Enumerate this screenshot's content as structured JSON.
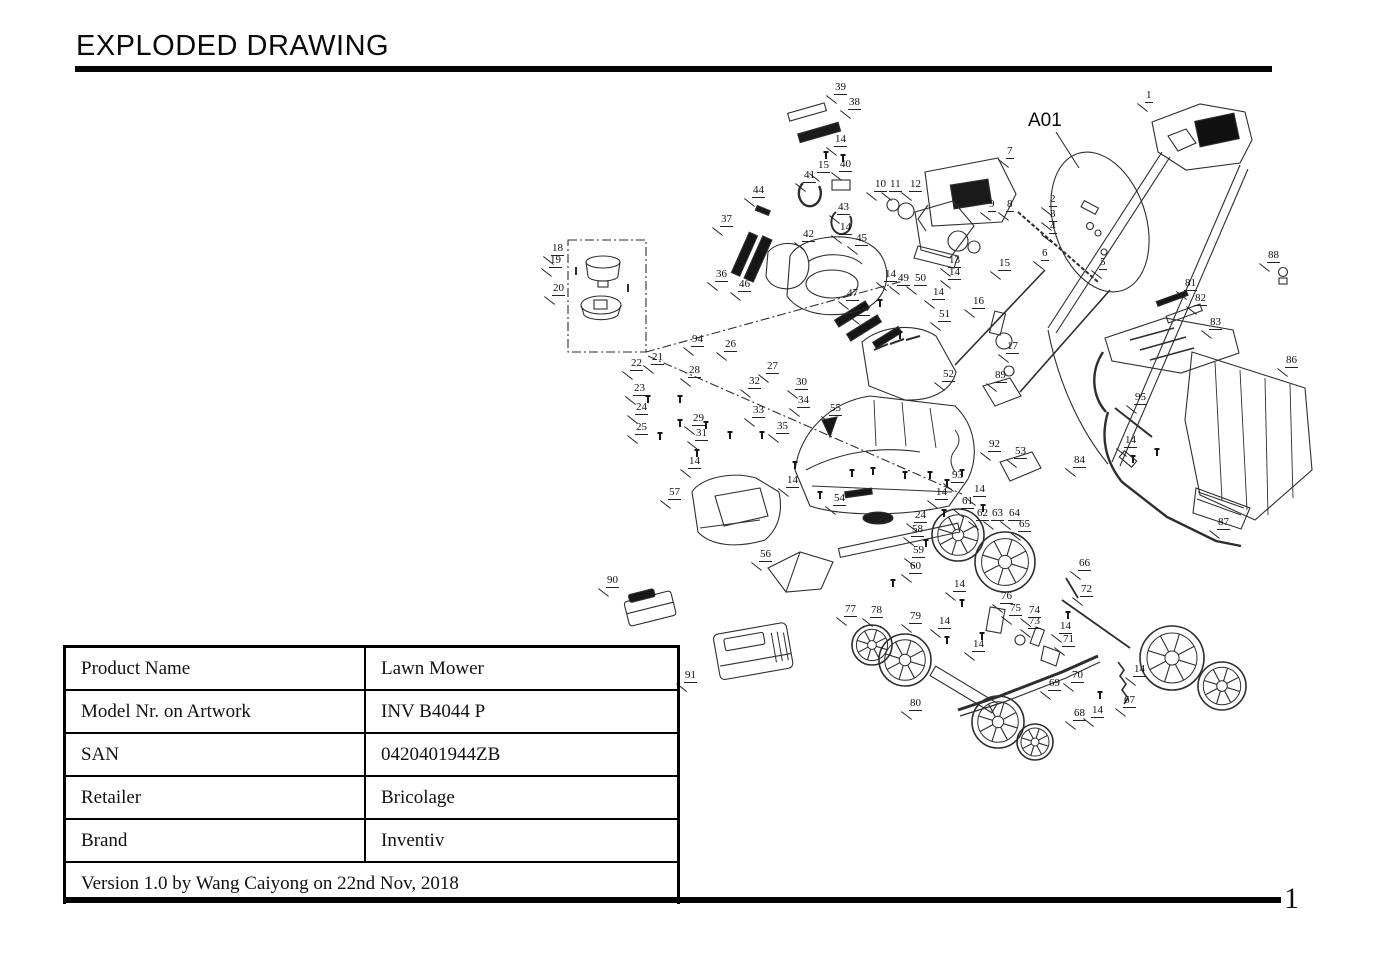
{
  "page": {
    "title": "EXPLODED DRAWING",
    "page_number": "1"
  },
  "diagram": {
    "assembly_callout": "A01",
    "labels": [
      {
        "n": "39",
        "x": 843,
        "y": 90
      },
      {
        "n": "38",
        "x": 857,
        "y": 105
      },
      {
        "n": "14",
        "x": 843,
        "y": 142
      },
      {
        "n": "15",
        "x": 826,
        "y": 168
      },
      {
        "n": "40",
        "x": 848,
        "y": 167
      },
      {
        "n": "41",
        "x": 812,
        "y": 178
      },
      {
        "n": "44",
        "x": 761,
        "y": 193
      },
      {
        "n": "43",
        "x": 846,
        "y": 210
      },
      {
        "n": "37",
        "x": 729,
        "y": 222
      },
      {
        "n": "42",
        "x": 811,
        "y": 237
      },
      {
        "n": "14",
        "x": 848,
        "y": 230
      },
      {
        "n": "45",
        "x": 864,
        "y": 241
      },
      {
        "n": "36",
        "x": 724,
        "y": 277
      },
      {
        "n": "46",
        "x": 747,
        "y": 287
      },
      {
        "n": "47",
        "x": 855,
        "y": 296
      },
      {
        "n": "48",
        "x": 866,
        "y": 311
      },
      {
        "n": "10",
        "x": 883,
        "y": 187
      },
      {
        "n": "11",
        "x": 898,
        "y": 187
      },
      {
        "n": "12",
        "x": 918,
        "y": 187
      },
      {
        "n": "7",
        "x": 1015,
        "y": 154
      },
      {
        "n": "9",
        "x": 997,
        "y": 207
      },
      {
        "n": "8",
        "x": 1015,
        "y": 207
      },
      {
        "n": "13",
        "x": 957,
        "y": 263
      },
      {
        "n": "14",
        "x": 957,
        "y": 275
      },
      {
        "n": "15",
        "x": 1007,
        "y": 266
      },
      {
        "n": "16",
        "x": 981,
        "y": 304
      },
      {
        "n": "17",
        "x": 1015,
        "y": 349
      },
      {
        "n": "14",
        "x": 893,
        "y": 277
      },
      {
        "n": "49",
        "x": 906,
        "y": 281
      },
      {
        "n": "50",
        "x": 923,
        "y": 281
      },
      {
        "n": "14",
        "x": 941,
        "y": 295
      },
      {
        "n": "51",
        "x": 947,
        "y": 317
      },
      {
        "n": "1",
        "x": 1154,
        "y": 98
      },
      {
        "n": "2",
        "x": 1058,
        "y": 202
      },
      {
        "n": "3",
        "x": 1058,
        "y": 217
      },
      {
        "n": "4",
        "x": 1058,
        "y": 229
      },
      {
        "n": "6",
        "x": 1050,
        "y": 256
      },
      {
        "n": "5",
        "x": 1108,
        "y": 265
      },
      {
        "n": "88",
        "x": 1276,
        "y": 258
      },
      {
        "n": "81",
        "x": 1193,
        "y": 286
      },
      {
        "n": "82",
        "x": 1203,
        "y": 301
      },
      {
        "n": "83",
        "x": 1218,
        "y": 325
      },
      {
        "n": "86",
        "x": 1294,
        "y": 363
      },
      {
        "n": "95",
        "x": 1143,
        "y": 400
      },
      {
        "n": "14",
        "x": 1133,
        "y": 443
      },
      {
        "n": "84",
        "x": 1082,
        "y": 463
      },
      {
        "n": "87",
        "x": 1226,
        "y": 525
      },
      {
        "n": "18",
        "x": 560,
        "y": 251
      },
      {
        "n": "19",
        "x": 558,
        "y": 263
      },
      {
        "n": "20",
        "x": 561,
        "y": 291
      },
      {
        "n": "94",
        "x": 700,
        "y": 342
      },
      {
        "n": "26",
        "x": 733,
        "y": 347
      },
      {
        "n": "21",
        "x": 660,
        "y": 360
      },
      {
        "n": "22",
        "x": 639,
        "y": 366
      },
      {
        "n": "28",
        "x": 697,
        "y": 373
      },
      {
        "n": "27",
        "x": 775,
        "y": 369
      },
      {
        "n": "32",
        "x": 757,
        "y": 384
      },
      {
        "n": "30",
        "x": 804,
        "y": 385
      },
      {
        "n": "23",
        "x": 642,
        "y": 391
      },
      {
        "n": "34",
        "x": 806,
        "y": 403
      },
      {
        "n": "24",
        "x": 644,
        "y": 410
      },
      {
        "n": "33",
        "x": 761,
        "y": 413
      },
      {
        "n": "29",
        "x": 701,
        "y": 421
      },
      {
        "n": "25",
        "x": 644,
        "y": 430
      },
      {
        "n": "31",
        "x": 704,
        "y": 436
      },
      {
        "n": "35",
        "x": 785,
        "y": 429
      },
      {
        "n": "55",
        "x": 838,
        "y": 411
      },
      {
        "n": "52",
        "x": 951,
        "y": 377
      },
      {
        "n": "89",
        "x": 1003,
        "y": 378
      },
      {
        "n": "92",
        "x": 997,
        "y": 447
      },
      {
        "n": "53",
        "x": 1023,
        "y": 454
      },
      {
        "n": "93",
        "x": 960,
        "y": 478
      },
      {
        "n": "14",
        "x": 944,
        "y": 495
      },
      {
        "n": "14",
        "x": 982,
        "y": 492
      },
      {
        "n": "14",
        "x": 795,
        "y": 483
      },
      {
        "n": "14",
        "x": 697,
        "y": 464
      },
      {
        "n": "57",
        "x": 677,
        "y": 495
      },
      {
        "n": "54",
        "x": 842,
        "y": 501
      },
      {
        "n": "56",
        "x": 768,
        "y": 557
      },
      {
        "n": "24",
        "x": 923,
        "y": 518
      },
      {
        "n": "61",
        "x": 970,
        "y": 504
      },
      {
        "n": "62",
        "x": 985,
        "y": 516
      },
      {
        "n": "63",
        "x": 1000,
        "y": 516
      },
      {
        "n": "64",
        "x": 1017,
        "y": 516
      },
      {
        "n": "65",
        "x": 1027,
        "y": 527
      },
      {
        "n": "58",
        "x": 920,
        "y": 532
      },
      {
        "n": "59",
        "x": 921,
        "y": 553
      },
      {
        "n": "60",
        "x": 918,
        "y": 569
      },
      {
        "n": "90",
        "x": 615,
        "y": 583
      },
      {
        "n": "91",
        "x": 693,
        "y": 678
      },
      {
        "n": "14",
        "x": 962,
        "y": 587
      },
      {
        "n": "76",
        "x": 1009,
        "y": 599
      },
      {
        "n": "75",
        "x": 1018,
        "y": 611
      },
      {
        "n": "74",
        "x": 1037,
        "y": 613
      },
      {
        "n": "73",
        "x": 1037,
        "y": 624
      },
      {
        "n": "77",
        "x": 853,
        "y": 612
      },
      {
        "n": "78",
        "x": 879,
        "y": 613
      },
      {
        "n": "79",
        "x": 918,
        "y": 619
      },
      {
        "n": "14",
        "x": 947,
        "y": 624
      },
      {
        "n": "66",
        "x": 1087,
        "y": 566
      },
      {
        "n": "72",
        "x": 1089,
        "y": 592
      },
      {
        "n": "14",
        "x": 1068,
        "y": 629
      },
      {
        "n": "71",
        "x": 1071,
        "y": 642
      },
      {
        "n": "14",
        "x": 981,
        "y": 647
      },
      {
        "n": "69",
        "x": 1057,
        "y": 686
      },
      {
        "n": "70",
        "x": 1080,
        "y": 678
      },
      {
        "n": "68",
        "x": 1082,
        "y": 716
      },
      {
        "n": "14",
        "x": 1100,
        "y": 713
      },
      {
        "n": "14",
        "x": 1142,
        "y": 672
      },
      {
        "n": "67",
        "x": 1132,
        "y": 703
      },
      {
        "n": "80",
        "x": 918,
        "y": 706
      }
    ]
  },
  "table": {
    "rows": [
      {
        "label": "Product Name",
        "value": "Lawn Mower"
      },
      {
        "label": "Model Nr. on Artwork",
        "value": "INV B4044 P"
      },
      {
        "label": "SAN",
        "value": "0420401944ZB"
      },
      {
        "label": "Retailer",
        "value": "Bricolage"
      },
      {
        "label": "Brand",
        "value": "Inventiv"
      }
    ],
    "footer": "Version 1.0 by Wang Caiyong on 22nd Nov,  2018"
  }
}
